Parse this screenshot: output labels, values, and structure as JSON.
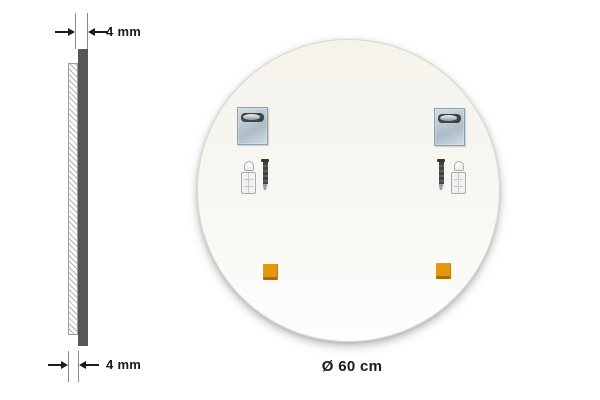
{
  "figure": {
    "side_view": {
      "top_thickness_label": "4 mm",
      "bottom_thickness_label": "4 mm"
    },
    "back_view": {
      "diameter_label": "Ø 60 cm",
      "hardware_icons": {
        "brackets": "hanging-bracket-icon",
        "screws": "screw-icon",
        "anchors": "wall-plug-icon",
        "pads": "adhesive-pad-icon"
      }
    }
  },
  "colors": {
    "glass": "#575757",
    "hatch-line": "#b4b4b4",
    "hatch-border": "#9e9e9e",
    "ext-line": "#8a8a8a",
    "dim-line": "#1b1b1b",
    "text": "#1a1a1a",
    "mirror-top": "#f5f3ec",
    "mirror-mid": "#f8f6f1",
    "mirror-bottom": "#fdfdfc",
    "mirror-border": "#d9d7d0",
    "bracket-a": "#d2dce2",
    "bracket-b": "#adbcc6",
    "bracket-border": "#8da0ab",
    "slot": "#3f4447",
    "washer-a": "#eef1f2",
    "washer-b": "#8e979c",
    "screw-dark": "#3e4346",
    "screw-mid": "#585d60",
    "screw-tip": "#9aa0a3",
    "anchor-fill": "#f0f2f1",
    "anchor-line": "#c6c8c7",
    "anchor-border": "#a9aba9",
    "pad": "#e5950e",
    "pad-edge": "#a96d05"
  }
}
